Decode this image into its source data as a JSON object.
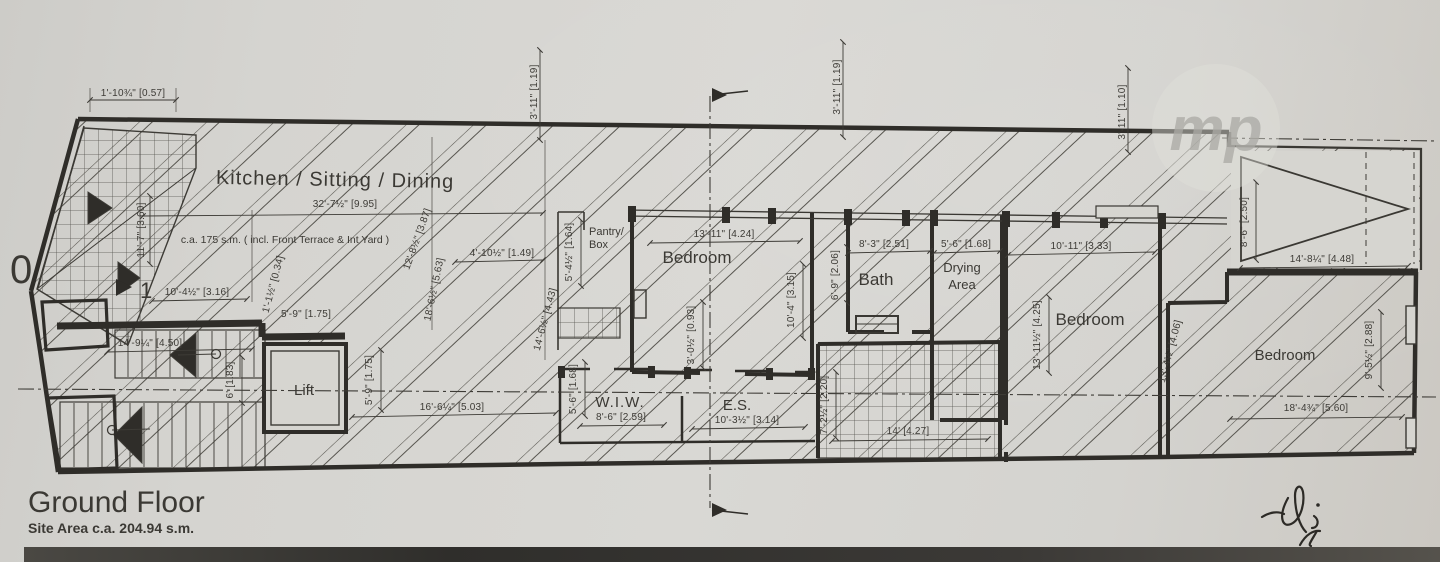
{
  "title_block": {
    "title": "Ground Floor",
    "subtitle": "Site Area c.a. 204.94 s.m."
  },
  "area_note": "c.a. 175 s.m. ( incl. Front Terrace & Int Yard )",
  "watermark": {
    "text": "mp"
  },
  "markers": {
    "level_marker": "1",
    "edge_digit": "0"
  },
  "rooms": {
    "kitchen": "Kitchen / Sitting / Dining",
    "pantry_line1": "Pantry/",
    "pantry_line2": "Box",
    "bedroom1": "Bedroom",
    "bath": "Bath",
    "drying_line1": "Drying",
    "drying_line2": "Area",
    "bedroom2": "Bedroom",
    "bedroom3": "Bedroom",
    "lift": "Lift",
    "wiw": "W.I.W.",
    "es": "E.S."
  },
  "dimensions": [
    "1'-10¾\" [0.57]",
    "3'-11\" [1.19]",
    "3'-11\" [1.19]",
    "3'-11\" [1.10]",
    "32'-7½\" [9.95]",
    "11'-7\" [3.60]",
    "10'-4½\" [3.16]",
    "1'-1½\" [0.34]",
    "5'-9\" [1.75]",
    "12'-8½\" [3.87]",
    "18'-6½\" [5.63]",
    "4'-10½\" [1.49]",
    "5'-4½\" [1.64]",
    "14'-6½\" [4.43]",
    "14'-9¼\" [4.50]",
    "6' [1.83]",
    "5'-9\" [1.75]",
    "16'-6¼\" [5.03]",
    "5'-6\" [1.68]",
    "8'-6\" [2.59]",
    "13'-11\" [4.24]",
    "3'-0½\" [0.93]",
    "10'-3½\" [3.14]",
    "10'-4\" [3.15]",
    "8'-3\" [2.51]",
    "6'-9\" [2.06]",
    "7'-2½\" [2.20]",
    "14' [4.27]",
    "5'-6\" [1.68]",
    "10'-11\" [3.33]",
    "13'-11½\" [4.25]",
    "13'-4½\" [4.06]",
    "8'-6\" [2.50]",
    "14'-8¼\" [4.48]",
    "9'-5½\" [2.88]",
    "18'-4¾\" [5.60]"
  ],
  "colors": {
    "paper": "#d6d5d0",
    "ink": "#3a3833",
    "wall": "#2f2d29"
  }
}
